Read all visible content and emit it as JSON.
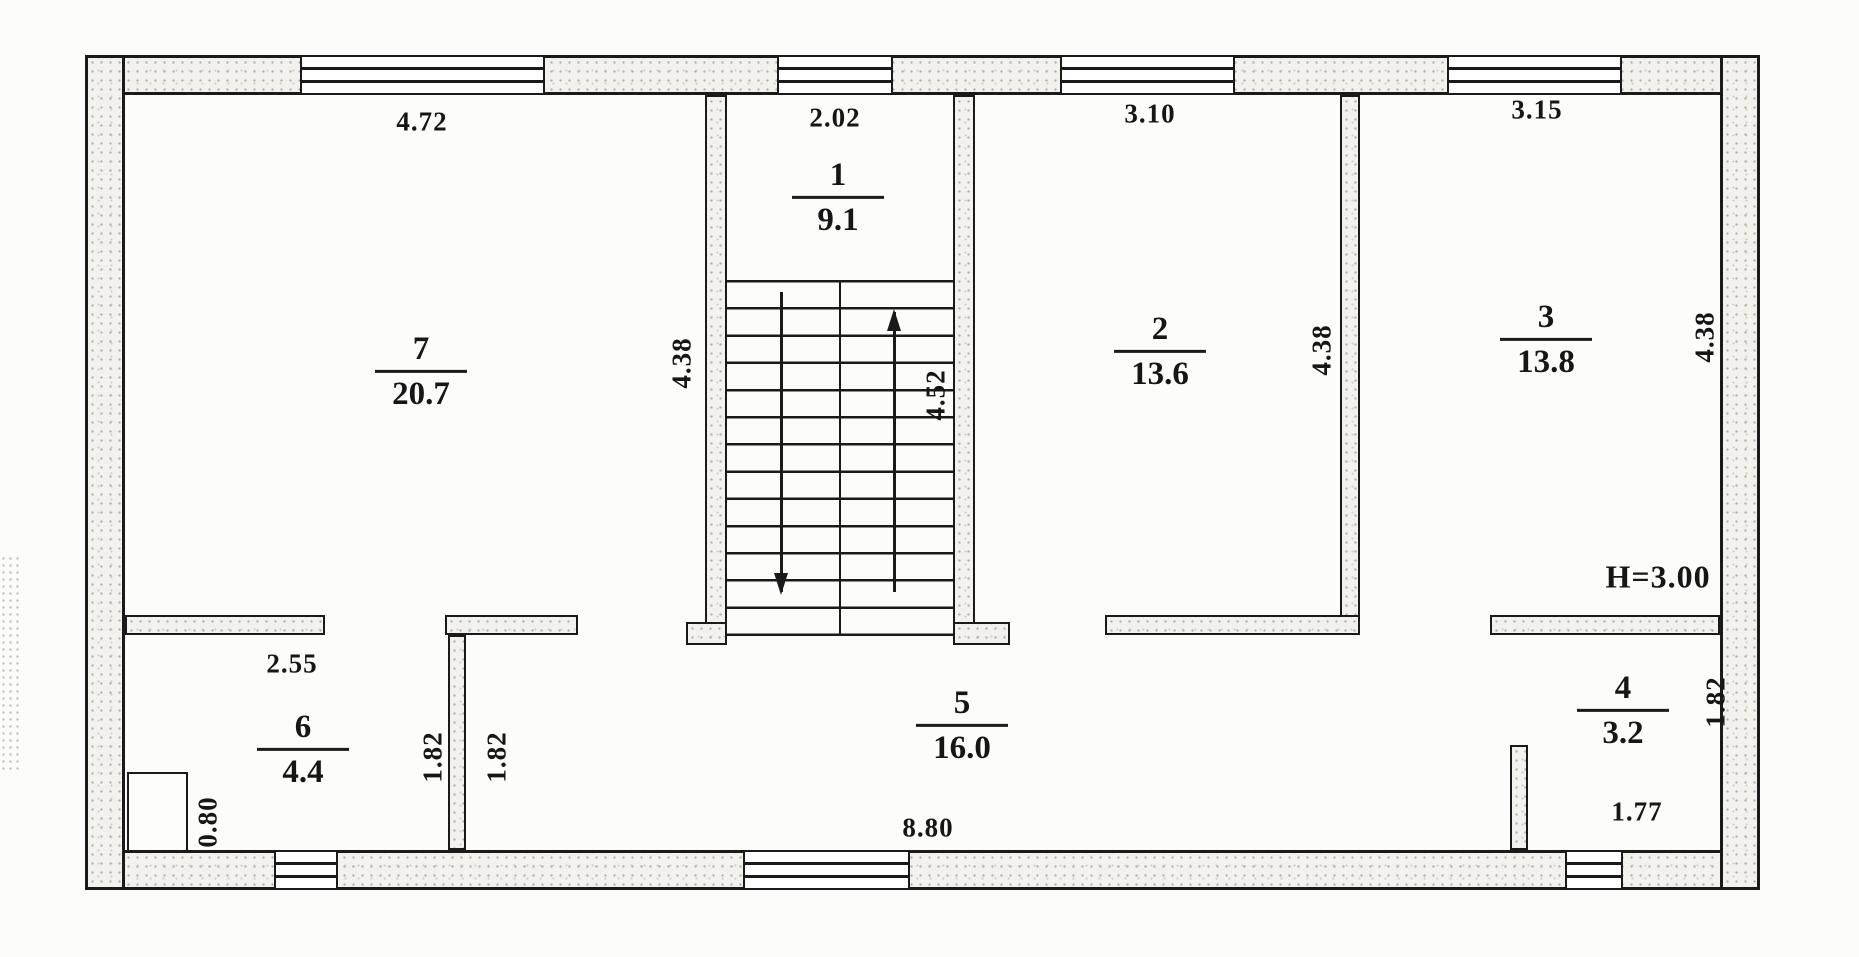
{
  "plan": {
    "rooms": [
      {
        "number": "1",
        "area": "9.1"
      },
      {
        "number": "2",
        "area": "13.6"
      },
      {
        "number": "3",
        "area": "13.8"
      },
      {
        "number": "4",
        "area": "3.2"
      },
      {
        "number": "5",
        "area": "16.0"
      },
      {
        "number": "6",
        "area": "4.4"
      },
      {
        "number": "7",
        "area": "20.7"
      }
    ],
    "dims": {
      "room7_width": "4.72",
      "room1_width": "2.02",
      "room2_width": "3.10",
      "room3_width": "3.15",
      "room7_depth": "4.38",
      "stair_depth": "4.52",
      "room2_depth": "4.38",
      "room3_depth": "4.38",
      "room6_width": "2.55",
      "room6_niche": "0.80",
      "partition_len_left": "1.82",
      "partition_len_right": "1.82",
      "corridor_length": "8.80",
      "room4_width": "1.77",
      "room4_depth": "1.82",
      "ceiling_height": "H=3.00"
    },
    "colors": {
      "line": "#1a1a1a",
      "wall_fill": "#f2f1ed",
      "paper": "#fcfcfa"
    }
  }
}
